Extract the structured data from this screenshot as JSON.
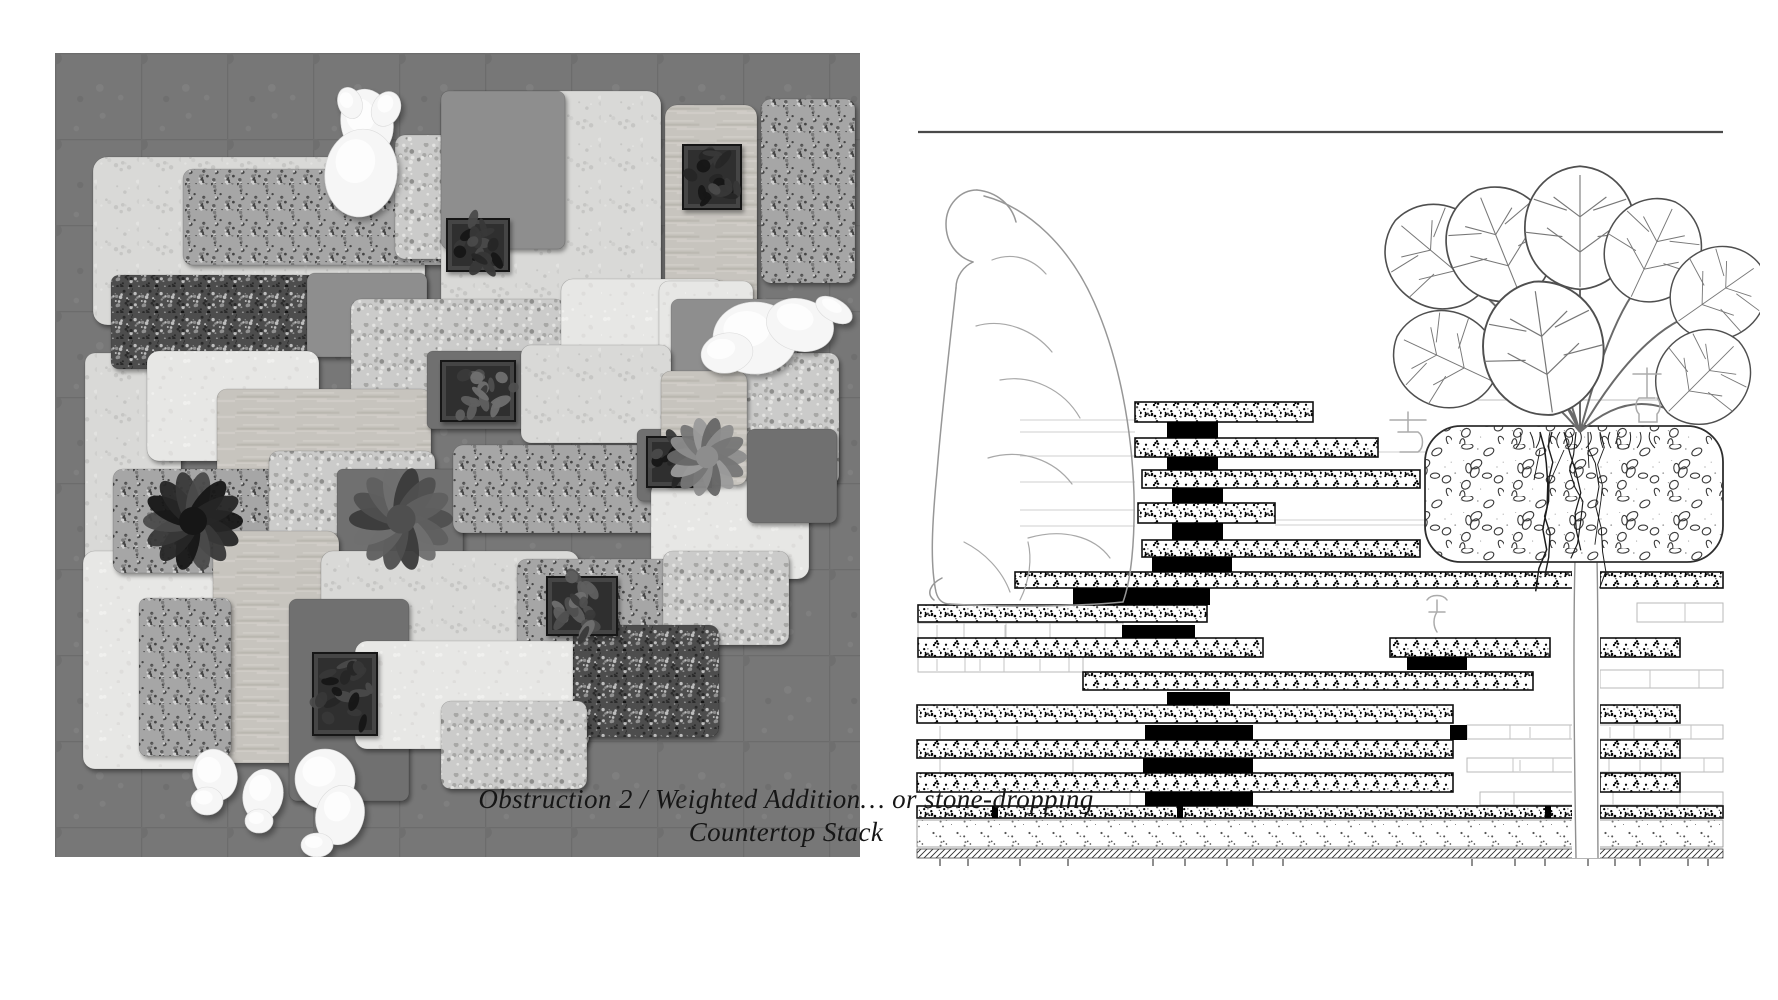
{
  "caption": {
    "line1": "Obstruction 2 / Weighted Addition… or stone-dropping",
    "line2": "Countertop Stack"
  },
  "left_figure": {
    "floor": {
      "color": "#7c7c7c",
      "line": "#6e6e6e",
      "tile": 86
    },
    "palette": {
      "ML": "#d9d9d7",
      "MW": "#e7e7e5",
      "TZ": "#cbcbca",
      "GM": "#a6a6a6",
      "GD": "#4d4d4d",
      "PG": "#8e8e8e",
      "PD": "#6f6f6f",
      "TR": "#c7c4be"
    },
    "slabs": [
      [
        30,
        300,
        96,
        236,
        10,
        "ML"
      ],
      [
        28,
        498,
        142,
        218,
        12,
        "MW"
      ],
      [
        38,
        104,
        332,
        168,
        14,
        "ML"
      ],
      [
        128,
        116,
        334,
        96,
        10,
        "GM"
      ],
      [
        340,
        82,
        154,
        124,
        10,
        "TZ"
      ],
      [
        386,
        38,
        220,
        226,
        14,
        "ML"
      ],
      [
        386,
        38,
        124,
        158,
        8,
        "PG"
      ],
      [
        610,
        52,
        92,
        240,
        12,
        "TR"
      ],
      [
        706,
        46,
        94,
        184,
        10,
        "GM"
      ],
      [
        56,
        222,
        204,
        94,
        8,
        "GD"
      ],
      [
        252,
        220,
        120,
        84,
        8,
        "PG"
      ],
      [
        296,
        246,
        214,
        122,
        10,
        "TZ"
      ],
      [
        506,
        226,
        164,
        112,
        12,
        "MW"
      ],
      [
        92,
        298,
        172,
        110,
        12,
        "MW"
      ],
      [
        162,
        336,
        214,
        92,
        10,
        "TR"
      ],
      [
        604,
        228,
        94,
        102,
        10,
        "MW"
      ],
      [
        616,
        246,
        126,
        98,
        8,
        "PG"
      ],
      [
        666,
        300,
        118,
        132,
        10,
        "TZ"
      ],
      [
        372,
        298,
        100,
        78,
        6,
        "PD"
      ],
      [
        466,
        292,
        150,
        98,
        10,
        "ML"
      ],
      [
        58,
        416,
        164,
        104,
        10,
        "GM"
      ],
      [
        214,
        398,
        166,
        112,
        10,
        "TZ"
      ],
      [
        282,
        416,
        126,
        98,
        6,
        "PD"
      ],
      [
        398,
        392,
        212,
        88,
        10,
        "GM"
      ],
      [
        582,
        376,
        98,
        72,
        6,
        "PD"
      ],
      [
        596,
        428,
        158,
        98,
        12,
        "MW"
      ],
      [
        606,
        318,
        86,
        114,
        10,
        "TR"
      ],
      [
        158,
        478,
        126,
        232,
        12,
        "TR"
      ],
      [
        266,
        498,
        258,
        98,
        12,
        "ML"
      ],
      [
        84,
        545,
        92,
        158,
        8,
        "GM"
      ],
      [
        462,
        506,
        156,
        98,
        10,
        "GM"
      ],
      [
        608,
        498,
        126,
        94,
        10,
        "TZ"
      ],
      [
        234,
        546,
        120,
        202,
        8,
        "PD"
      ],
      [
        300,
        588,
        234,
        108,
        12,
        "MW"
      ],
      [
        518,
        572,
        146,
        112,
        10,
        "GD"
      ],
      [
        386,
        648,
        146,
        88,
        10,
        "TZ"
      ],
      [
        692,
        376,
        90,
        94,
        8,
        "PD"
      ]
    ],
    "planters": [
      [
        628,
        92,
        58,
        64,
        "dark"
      ],
      [
        392,
        166,
        62,
        52,
        "dark"
      ],
      [
        386,
        308,
        74,
        60,
        "mid"
      ],
      [
        592,
        384,
        64,
        50,
        "dark"
      ],
      [
        492,
        524,
        70,
        58,
        "mid"
      ],
      [
        258,
        600,
        64,
        82,
        "dark"
      ]
    ],
    "plants": [
      [
        138,
        468,
        50,
        "dark"
      ],
      [
        346,
        466,
        52,
        "mid"
      ],
      [
        652,
        404,
        40,
        "light"
      ]
    ],
    "figures": [
      {
        "name": "seated-person-top",
        "ellipses": [
          [
            312,
            70,
            26,
            34,
            -10
          ],
          [
            306,
            120,
            36,
            44,
            8
          ],
          [
            331,
            56,
            14,
            18,
            25
          ],
          [
            295,
            50,
            12,
            16,
            -20
          ]
        ]
      },
      {
        "name": "reclining-person-right",
        "ellipses": [
          [
            700,
            285,
            42,
            36,
            0
          ],
          [
            745,
            272,
            34,
            26,
            15
          ],
          [
            779,
            257,
            20,
            11,
            30
          ],
          [
            672,
            300,
            26,
            20,
            -10
          ]
        ]
      },
      {
        "name": "crouching-person-1",
        "ellipses": [
          [
            160,
            722,
            22,
            26,
            -15
          ],
          [
            152,
            748,
            16,
            14,
            0
          ]
        ]
      },
      {
        "name": "crouching-person-2",
        "ellipses": [
          [
            208,
            742,
            20,
            26,
            10
          ],
          [
            204,
            768,
            14,
            12,
            0
          ]
        ]
      },
      {
        "name": "crouching-person-3",
        "ellipses": [
          [
            270,
            726,
            30,
            30,
            0
          ],
          [
            285,
            762,
            24,
            30,
            15
          ],
          [
            262,
            792,
            16,
            12,
            0
          ]
        ]
      }
    ]
  },
  "right_figure": {
    "frame_line": [
      38,
      52,
      843,
      52
    ],
    "level_line": [
      570,
      320,
      843,
      320
    ],
    "slabs": [
      [
        255,
        322,
        178,
        20
      ],
      [
        255,
        358,
        243,
        19
      ],
      [
        262,
        390,
        278,
        18
      ],
      [
        258,
        423,
        137,
        20
      ],
      [
        262,
        460,
        278,
        17
      ],
      [
        135,
        492,
        558,
        16
      ],
      [
        720,
        492,
        123,
        16
      ],
      [
        38,
        525,
        289,
        17
      ],
      [
        38,
        558,
        345,
        19
      ],
      [
        510,
        558,
        160,
        19
      ],
      [
        720,
        558,
        80,
        19
      ],
      [
        203,
        592,
        450,
        18
      ],
      [
        37,
        625,
        536,
        18
      ],
      [
        720,
        625,
        80,
        18
      ],
      [
        37,
        660,
        536,
        18
      ],
      [
        720,
        660,
        80,
        18
      ],
      [
        37,
        693,
        536,
        19
      ],
      [
        720,
        693,
        80,
        19
      ],
      [
        37,
        726,
        656,
        12
      ],
      [
        720,
        726,
        123,
        12
      ]
    ],
    "blocks": [
      [
        287,
        342,
        51,
        16
      ],
      [
        287,
        377,
        51,
        13
      ],
      [
        292,
        408,
        51,
        15
      ],
      [
        292,
        443,
        51,
        17
      ],
      [
        272,
        477,
        80,
        15
      ],
      [
        193,
        508,
        137,
        17
      ],
      [
        242,
        545,
        73,
        13
      ],
      [
        527,
        577,
        60,
        13
      ],
      [
        287,
        612,
        63,
        13
      ],
      [
        265,
        645,
        108,
        15
      ],
      [
        570,
        645,
        17,
        15
      ],
      [
        263,
        678,
        110,
        15
      ],
      [
        265,
        712,
        108,
        14
      ],
      [
        112,
        726,
        6,
        12
      ],
      [
        297,
        726,
        6,
        12
      ],
      [
        665,
        726,
        6,
        12
      ]
    ],
    "brick_rows": [
      [
        38,
        543,
        205,
        15
      ],
      [
        38,
        577,
        165,
        15
      ],
      [
        757,
        523,
        86,
        19
      ],
      [
        720,
        590,
        123,
        18
      ],
      [
        587,
        645,
        256,
        14
      ],
      [
        587,
        678,
        256,
        14
      ],
      [
        600,
        712,
        243,
        13
      ]
    ],
    "hairlines": [
      [
        140,
        340,
        255
      ],
      [
        140,
        352,
        255
      ],
      [
        140,
        376,
        255
      ],
      [
        140,
        402,
        255
      ],
      [
        140,
        430,
        255
      ],
      [
        140,
        446,
        255
      ],
      [
        340,
        440,
        573
      ],
      [
        395,
        445,
        585
      ],
      [
        330,
        372,
        585
      ],
      [
        340,
        408,
        540
      ]
    ],
    "vjoints": [
      [
        57,
        545,
        557
      ],
      [
        125,
        545,
        557
      ],
      [
        57,
        579,
        591
      ],
      [
        100,
        579,
        591
      ],
      [
        160,
        579,
        591
      ],
      [
        60,
        646,
        659
      ],
      [
        137,
        646,
        659
      ],
      [
        60,
        679,
        692
      ],
      [
        193,
        679,
        692
      ],
      [
        120,
        713,
        725
      ],
      [
        250,
        713,
        725
      ],
      [
        650,
        647,
        658
      ],
      [
        730,
        647,
        658
      ],
      [
        790,
        647,
        658
      ],
      [
        640,
        680,
        691
      ],
      [
        760,
        680,
        691
      ],
      [
        700,
        714,
        724
      ]
    ],
    "planter": {
      "x": 545,
      "y": 346,
      "w": 298,
      "h": 136,
      "r": 36
    },
    "trunk": {
      "x1": 695,
      "x2": 717,
      "y1": 480,
      "y2": 778
    },
    "sand": [
      37,
      740,
      806,
      27
    ],
    "hatch": [
      37,
      769,
      806,
      9
    ],
    "ticks": [
      60,
      88,
      140,
      188,
      273,
      305,
      347,
      373,
      403,
      592,
      635,
      665,
      708,
      735,
      760,
      808,
      828
    ],
    "leaves": [
      {
        "x": 598,
        "y": 210,
        "s": 1.0,
        "r": -50
      },
      {
        "x": 640,
        "y": 215,
        "s": 1.05,
        "r": -22
      },
      {
        "x": 700,
        "y": 205,
        "s": 1.1,
        "r": 0
      },
      {
        "x": 752,
        "y": 215,
        "s": 0.95,
        "r": 25
      },
      {
        "x": 800,
        "y": 240,
        "s": 0.9,
        "r": 55
      },
      {
        "x": 610,
        "y": 300,
        "s": 0.95,
        "r": -65
      },
      {
        "x": 672,
        "y": 330,
        "s": 1.2,
        "r": -8
      },
      {
        "x": 790,
        "y": 330,
        "s": 0.9,
        "r": 45
      }
    ],
    "leaf_path": "M0,4 C-26,2 -48,-18 -50,-48 C-52,-80 -30,-106 0,-108 C30,-106 52,-80 50,-48 C48,-18 26,2 0,4 Z",
    "leaf_details": [
      "M0,2 L0,-100",
      "M0,-30 L-30,-52",
      "M0,-30 L30,-52",
      "M0,-62 L-24,-80",
      "M0,-62 L24,-80",
      "M-50,-48 L-16,-44",
      "M50,-48 L16,-44",
      "M-42,-78 L-12,-68",
      "M42,-78 L12,-68"
    ],
    "figure_outline": [
      "M97,110 C80,110 66,125 66,144 C66,163 77,177 93,182",
      "M97,110 C118,112 132,126 136,142",
      "M93,182 C84,186 76,196 76,208",
      "M104,116 C150,128 190,168 214,222 C240,280 252,352 254,414 C255,462 251,500 243,522",
      "M243,522 C190,527 120,527 70,524",
      "M76,208 C70,262 62,330 57,392 C52,444 50,484 56,512 C58,520 63,524 70,524",
      "M62,498 C50,504 46,514 54,520"
    ],
    "figure_folds": [
      "M96,246 C124,238 154,250 172,272",
      "M120,300 C152,294 184,310 200,338",
      "M108,378 C142,368 174,380 192,404",
      "M148,458 C182,448 214,456 230,478",
      "M84,462 C104,472 122,490 130,512",
      "M112,180 C132,172 152,178 166,194",
      "M140,520 C150,500 152,478 148,462"
    ],
    "symbols": [
      {
        "name": "tap-clamp-icon",
        "x": 753,
        "y": 288,
        "path": "M0,6 L28,6 M14,0 L14,12 M14,12 L14,30 M6,30 L22,30 M6,30 C2,34 2,42 6,46 L6,54 L24,54 L24,46 C28,42 28,34 24,30"
      },
      {
        "name": "clamp-icon",
        "x": 510,
        "y": 330,
        "path": "M0,10 L36,10 M18,2 L18,22 M8,22 L28,22 M28,22 C34,26 34,38 28,42 L10,42"
      },
      {
        "name": "faucet-icon",
        "x": 547,
        "y": 512,
        "path": "M0,8 C4,2 16,2 20,8 M10,8 L10,20 M2,20 L18,20 M10,20 C6,26 6,34 10,40"
      }
    ]
  }
}
